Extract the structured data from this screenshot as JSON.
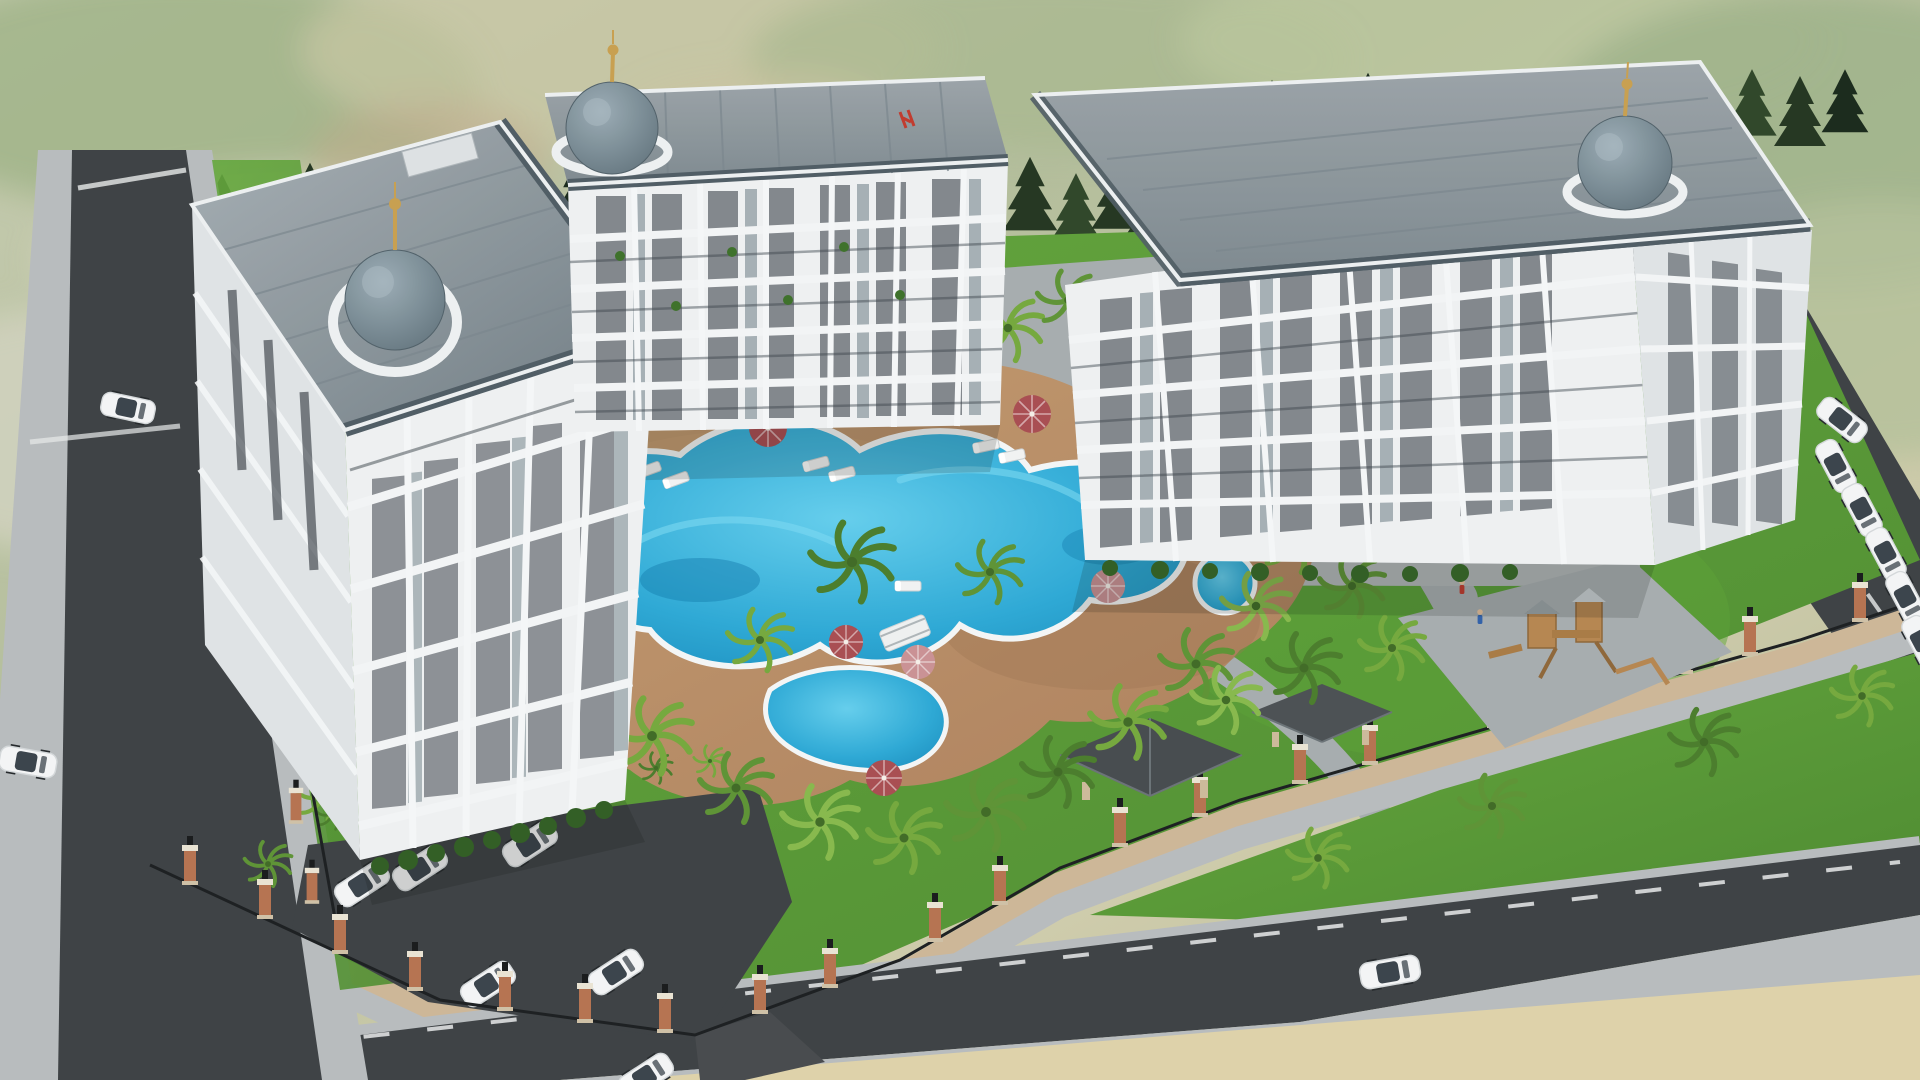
{
  "scene": {
    "type": "3d-architectural-rendering",
    "view": "aerial-perspective",
    "subject": "luxury residential complex with landscaped pool courtyard",
    "time_of_day": "day"
  },
  "palette": {
    "terrain_base": "#c6cbb0",
    "terrain_mid": "#b3bd9b",
    "terrain_tan": "#cfcbab",
    "terrain_green": "#a8b591",
    "conifer_dark": "#22351f",
    "building_wall": "#eef0f1",
    "building_wall_shaded": "#dfe3e5",
    "accent_slate": "#5d7078",
    "window_glass": "#2a3138",
    "roof_light": "#a6afb4",
    "roof_dark": "#6e7a81",
    "roof_band": "#4e5b63",
    "dome_light": "#9aacb5",
    "dome_dark": "#5b6c75",
    "finial_gold": "#c79f4e",
    "pool_water": "#2ba8d5",
    "pool_deep": "#1284b4",
    "pool_light": "#63cdec",
    "pool_coping": "#f3f5f5",
    "deck_brown": "#ad7f5b",
    "deck_light": "#c29a6f",
    "lawn": "#4c8a2e",
    "lawn_light": "#63a63c",
    "umbrella_red": "#a84c50",
    "umbrella_pink": "#c99093",
    "road_asphalt": "#3c4043",
    "road_line": "#e8eaea",
    "sidewalk": "#b7bbbd",
    "paver_gray": "#a6acae",
    "wall_stone": "#cdb696",
    "brick_pillar": "#b5724f",
    "pillar_cap": "#e9e3d3",
    "lamp_black": "#17191a",
    "car_white": "#f3f4f5",
    "car_glass": "#39424a",
    "wood_play": "#b5854f",
    "bridge_white": "#eef0f0",
    "sand": "#ded2a9",
    "roof_logo_red": "#c0392b"
  },
  "inventory": {
    "buildings": [
      {
        "id": "left",
        "floors_visible": 6,
        "dome": "front-corner",
        "roof": "pitched-gray-metal"
      },
      {
        "id": "middle",
        "floors_visible": 5,
        "dome": "left-corner",
        "roof": "flat-gray",
        "roof_logo": true
      },
      {
        "id": "right",
        "floors_visible": 5,
        "dome": "right-corner",
        "roof": "flat-gray"
      }
    ],
    "pools": {
      "count": 3,
      "style": "freeform-lagoon",
      "bridge": true,
      "spa_circle": true
    },
    "umbrellas": {
      "red": 7,
      "pink": 5
    },
    "sun_loungers": 12,
    "cars": {
      "parking_lot": 6,
      "left_road": 2,
      "bottom_road": 1,
      "right_road_moving": 1,
      "right_road_parked": 5
    },
    "vegetation": {
      "background_conifers": true,
      "palm_trees": 40,
      "lawns": true
    },
    "amenities": [
      "swimming-pools",
      "pool-bridge",
      "pergolas",
      "playground",
      "open-parking",
      "perimeter-fence-with-brick-pillars",
      "street-lamps"
    ]
  }
}
